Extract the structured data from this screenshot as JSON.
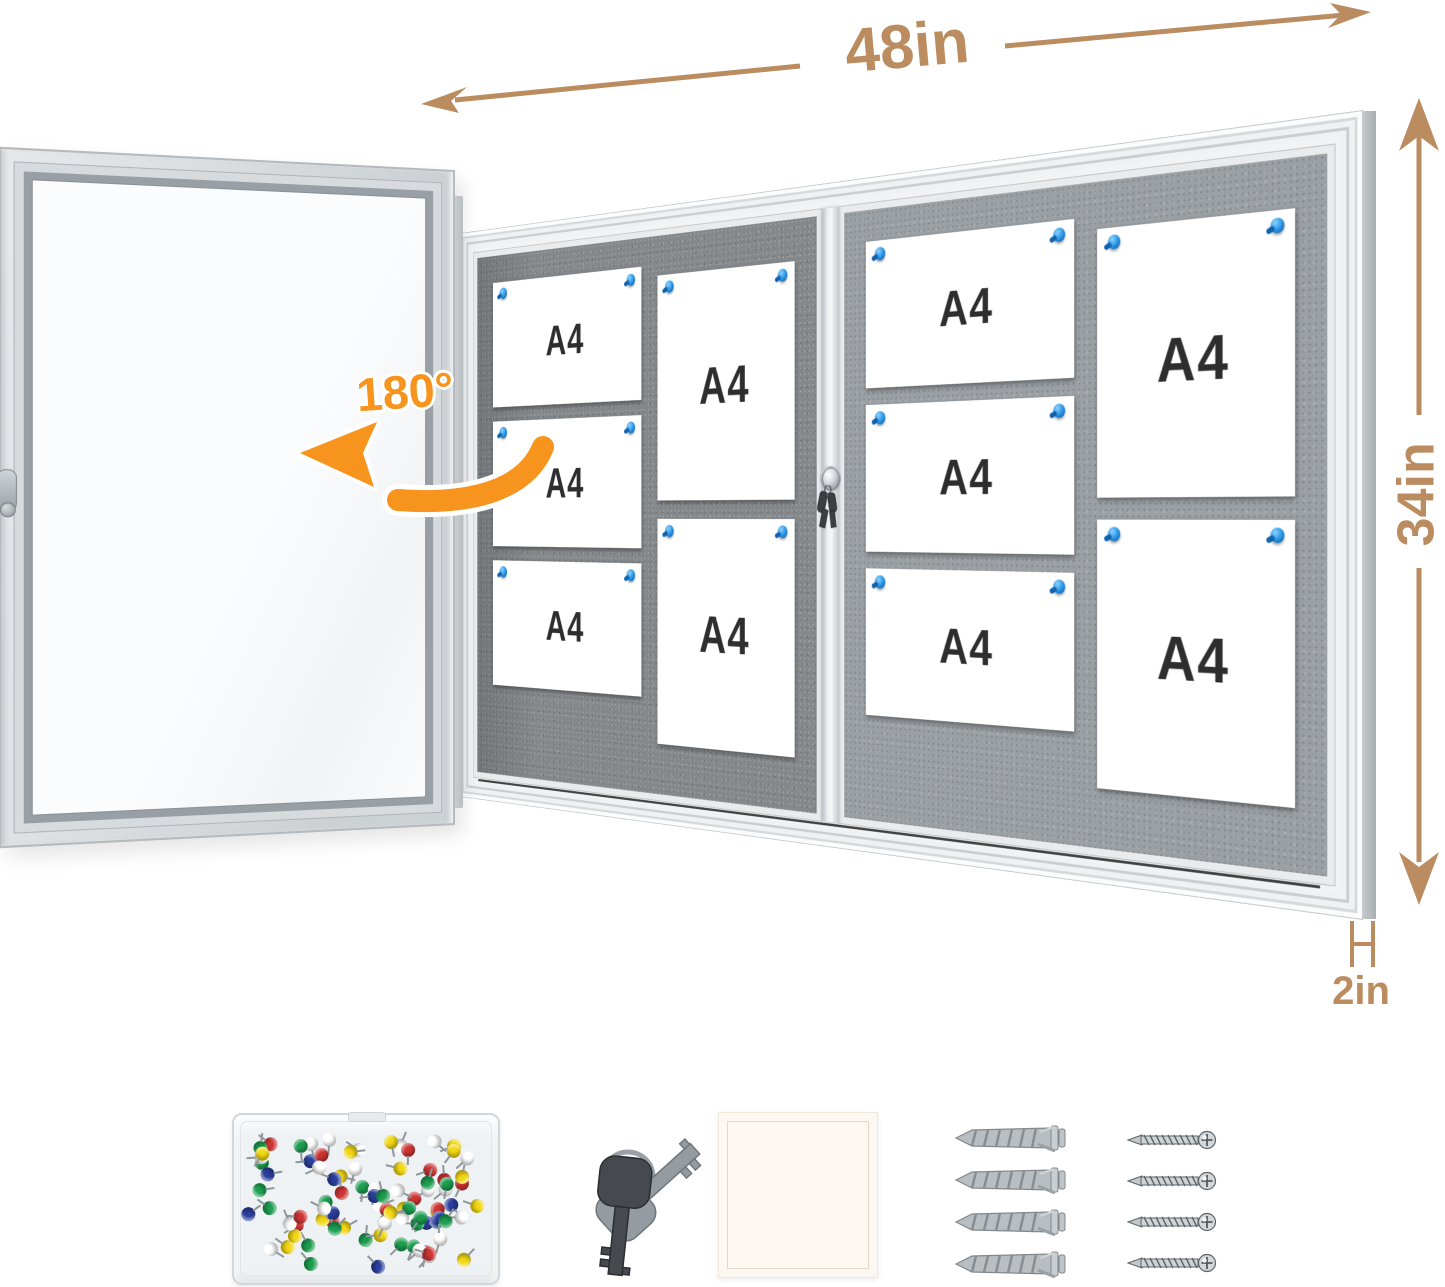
{
  "colors": {
    "tan": "#BA8C60",
    "orange": "#F7941E",
    "pin_blue": "#2F9BE9",
    "pin_blue_dark": "#1263AE",
    "felt_left": "#84888B",
    "felt_right": "#9BA0A4",
    "frame_face": "#F2F3F5",
    "paper": "#FFFFFF",
    "ink": "#2E2E2E"
  },
  "annotations": {
    "width_label": "48in",
    "height_label": "34in",
    "depth_label": "2in",
    "rotation_label": "180°"
  },
  "board": {
    "sheet_label": "A4",
    "panels": [
      {
        "name": "left-sliding-panel",
        "sheets": [
          "landscape",
          "landscape",
          "landscape",
          "portrait",
          "portrait"
        ]
      },
      {
        "name": "right-sliding-panel",
        "sheets": [
          "landscape",
          "landscape",
          "landscape",
          "portrait",
          "portrait"
        ]
      }
    ],
    "pin_color": "#2F9BE9",
    "locks": 1
  },
  "accessories": {
    "push_pin_box": {
      "pin_count": 88,
      "pin_colors": [
        "#CF3434",
        "#1D9E50",
        "#2B3F9E",
        "#F2D713",
        "#FFFFFF"
      ]
    },
    "keys": {
      "count": 2
    },
    "felt_pad": {
      "color": "#FCF8F1"
    },
    "wall_anchors": {
      "count": 4
    },
    "screws": {
      "count": 4
    }
  }
}
